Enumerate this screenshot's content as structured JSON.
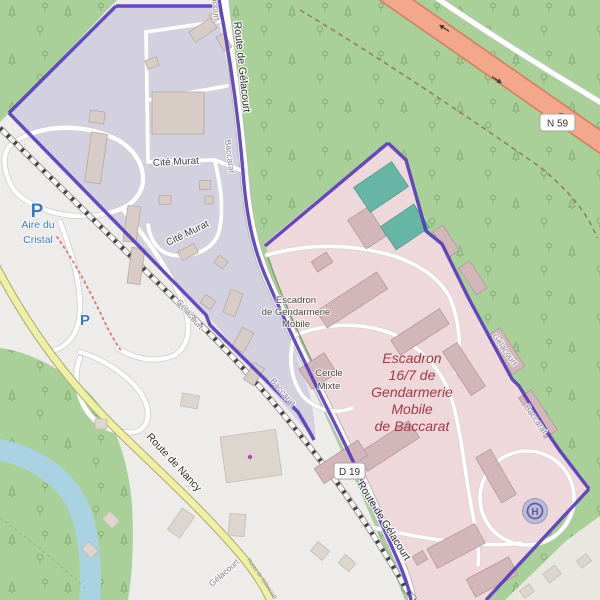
{
  "app": {
    "name": "map"
  },
  "colors": {
    "boundary_purple": "#5233b8",
    "military_area_pink": "#efd8dc",
    "barracks_area_lavender": "#d3d1df",
    "forest_green": "#a9d098",
    "water_blue": "#a9d2e2",
    "trunk_orange": "#f4a78a",
    "secondary_yellow": "#eef0a6",
    "military_label_red": "#9c3a42",
    "amenity_blue": "#3878bf"
  },
  "labels": {
    "roads": {
      "route_de_gelacourt": "Route de Gélacourt",
      "route_de_nancy": "Route de Nancy"
    },
    "shields": {
      "n59": "N 59",
      "d19": "D 19"
    },
    "communes": {
      "gelacourt": "Gélacourt",
      "baccarat": "Baccarat"
    },
    "places": {
      "cite_murat": "Cité Murat",
      "aire_du_cristal": [
        "Aire du",
        "Cristal"
      ],
      "parking": "P",
      "helipad": "H"
    },
    "military": {
      "poi": [
        "Escadron",
        "de Gendarmerie",
        "Mobile"
      ],
      "cercle_mixte": [
        "Cercle",
        "Mixte"
      ],
      "area_label": [
        "Escadron",
        "16/7 de",
        "Gendarmerie",
        "Mobile",
        "de Baccarat"
      ]
    }
  }
}
